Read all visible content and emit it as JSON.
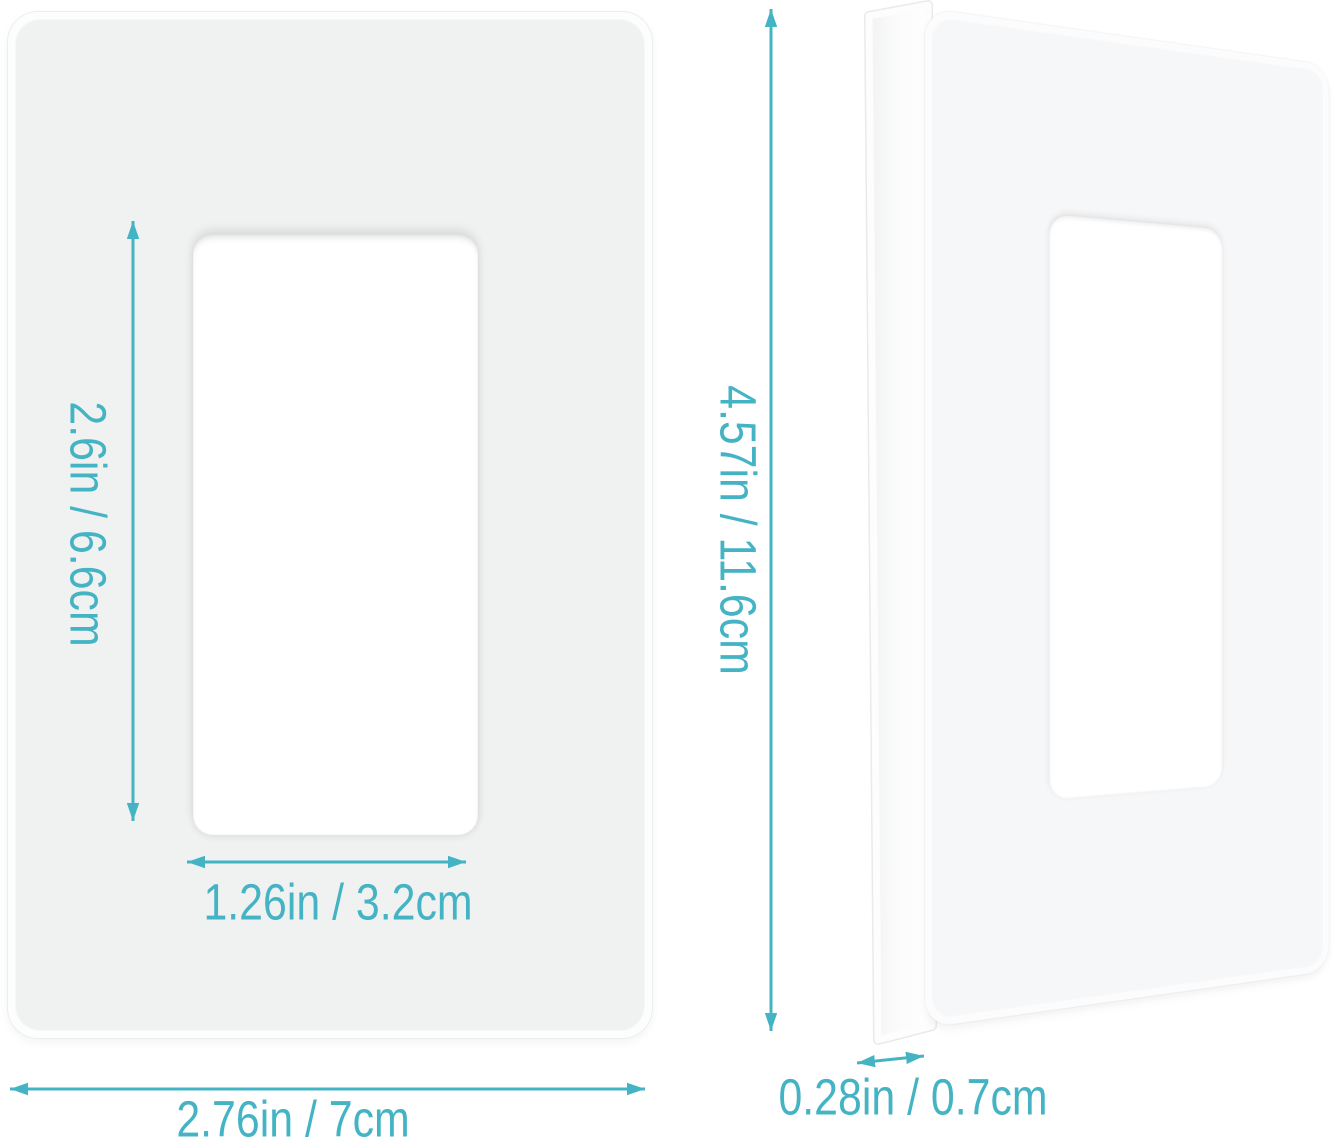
{
  "diagram": {
    "subject": "single-gang screwless decorator wall plate dimension diagram",
    "views": {
      "front_view": "plate front view with cutout",
      "side_view": "plate angled side view showing thickness"
    }
  },
  "dimensions": {
    "cutout_height": "2.6in / 6.6cm",
    "cutout_width": "1.26in / 3.2cm",
    "plate_width": "2.76in / 7cm",
    "plate_height": "4.57in / 11.6cm",
    "plate_thickness": "0.28in / 0.7cm"
  },
  "colors": {
    "accent": "#44b3c4",
    "plate_face": "#f0f1f1",
    "plate_bezel": "#fcfdfd",
    "background": "#ffffff"
  },
  "icons": {
    "arrows": "double-headed-dimension-arrow"
  }
}
